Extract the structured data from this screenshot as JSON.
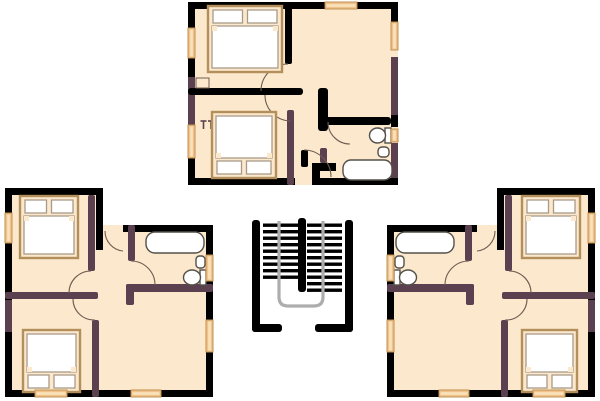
{
  "scene": {
    "type": "floor-plan",
    "description": "Three-apartment residential floor plan with a central double-flight staircase",
    "units": 3
  },
  "colors": {
    "background": "#FFFFFF",
    "floor": "#FCE8CC",
    "wall": "#000000",
    "wall_accent": "#5B4050",
    "window_fill": "#EFC28E",
    "window_edge": "#C2924F",
    "window_light": "#F9E2BC",
    "fixture_fill": "#FFFFFF",
    "fixture_stroke": "#54504A",
    "bed_frame": "#B28F5B",
    "bed_stroke": "#A89A88",
    "railing": "#ADADAD",
    "door_arc": "#6E5B52"
  },
  "apartments": [
    {
      "name": "top-apartment",
      "rooms": [
        "bedroom-1",
        "bedroom-2",
        "living-room",
        "bathroom"
      ],
      "fixtures": [
        "double-bed",
        "double-bed",
        "toilet",
        "sink",
        "bathtub"
      ],
      "windows": 5,
      "door_arcs": 4
    },
    {
      "name": "lower-left-apartment",
      "rooms": [
        "bedroom-1",
        "bedroom-2",
        "living-room",
        "bathroom",
        "hall"
      ],
      "fixtures": [
        "double-bed",
        "double-bed",
        "toilet",
        "sink",
        "bathtub"
      ],
      "windows": 5,
      "door_arcs": 4
    },
    {
      "name": "lower-right-apartment",
      "rooms": [
        "bedroom-1",
        "bedroom-2",
        "living-room",
        "bathroom",
        "hall"
      ],
      "fixtures": [
        "double-bed",
        "double-bed",
        "toilet",
        "sink",
        "bathtub"
      ],
      "windows": 5,
      "door_arcs": 4
    }
  ],
  "staircase": {
    "flights": 2,
    "treads_per_flight": [
      9,
      11
    ],
    "railing": true
  }
}
